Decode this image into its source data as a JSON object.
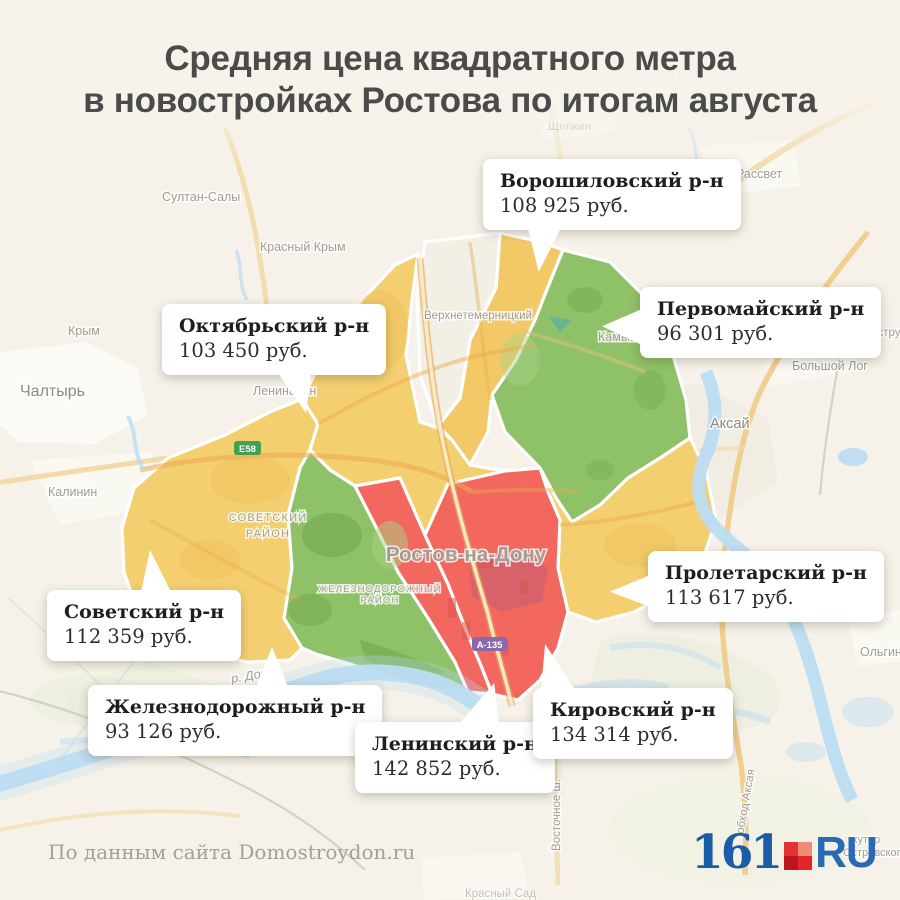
{
  "title": {
    "line1": "Средняя цена квадратного метра",
    "line2": "в новостройках Ростова по итогам августа"
  },
  "callouts": [
    {
      "name": "Ворошиловский р-н",
      "price": "108 925 руб."
    },
    {
      "name": "Первомайский р-н",
      "price": "96 301 руб."
    },
    {
      "name": "Октябрьский р-н",
      "price": "103 450 руб."
    },
    {
      "name": "Советский р-н",
      "price": "112 359 руб."
    },
    {
      "name": "Железнодорожный р-н",
      "price": "93 126 руб."
    },
    {
      "name": "Ленинский р-н",
      "price": "142 852 руб."
    },
    {
      "name": "Кировский р-н",
      "price": "134 314 руб."
    },
    {
      "name": "Пролетарский р-н",
      "price": "113 617 руб."
    }
  ],
  "map": {
    "city": "Ростов-на-Дону",
    "area_labels": {
      "sovetsky_line1": "СОВЕТСКИЙ",
      "sovetsky_line2": "РАЙОН",
      "zhel_line1": "ЖЕЛЕЗНОДОРОЖНЫЙ",
      "zhel_line2": "РАЙОН"
    },
    "towns": {
      "chaltyr": "Чалтырь",
      "kalinin": "Калинин",
      "krym": "Крым",
      "sultan_saly": "Султан-Салы",
      "krasny_krym": "Красный Крым",
      "shchepkin": "Щепкин",
      "rassvet": "Рассвет",
      "krasny": "Красный",
      "oktyabrsky_faint": "Октябрьский",
      "verkhnetemernitsky": "Верхнетемерницкий",
      "leninavan": "Ленинаван",
      "kamyshevakha": "Камышеваха",
      "aksay": "Аксай",
      "bolshoy_log": "Большой Лог",
      "rekonstruktor": "Реконструктор",
      "olginskaya": "Ольгинская",
      "krasny_sad": "Красный Сад",
      "khutor_line1": "хутор",
      "khutor_line2": "Островского"
    },
    "river": "р. Дон",
    "badges": {
      "e58": "Е58",
      "a135": "А-135"
    },
    "road_labels": {
      "vostochnoe": "Восточное ш.",
      "obkhod": "обход Аксая"
    }
  },
  "footer": {
    "source": "По данным сайта Domostroydon.ru"
  },
  "logo": {
    "number": "161",
    "suffix": "RU"
  },
  "colors": {
    "district_yellow": "#f4cf70",
    "district_orange": "#f3c968",
    "district_green": "#8fc168",
    "district_red": "#f2685f",
    "water": "#badcf2",
    "title_text": "#4b4b4b",
    "logo_blue": "#1b5ca8",
    "logo_red": "#e31e24"
  }
}
